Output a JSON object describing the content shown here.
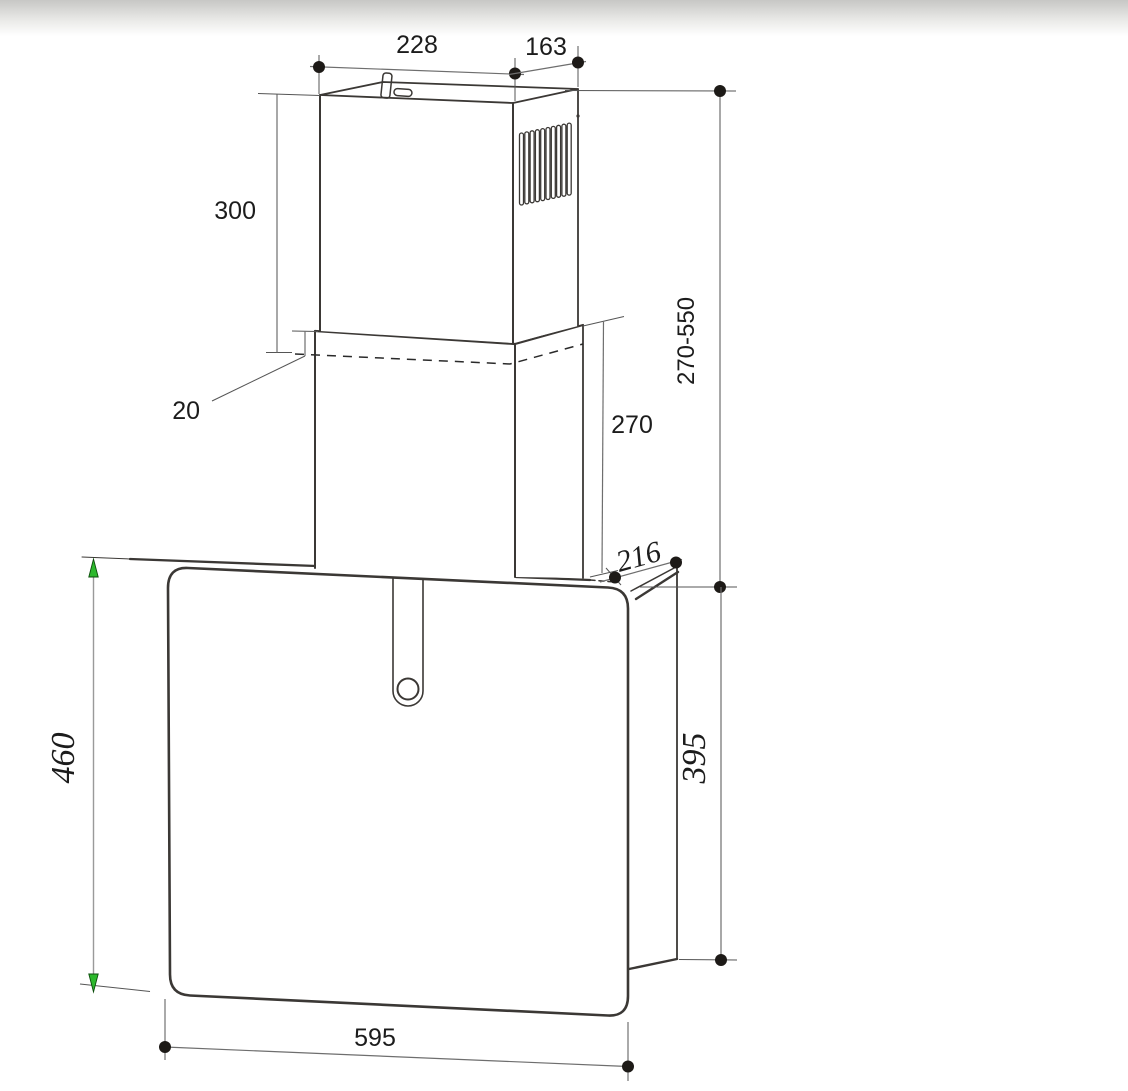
{
  "drawing": {
    "description": "Cooker hood installation dimensional drawing",
    "dimensions": {
      "top_width": "228",
      "top_depth": "163",
      "upper_chimney_height": "300",
      "chimney_overlap": "20",
      "chimney_height_range": "270-550",
      "lower_chimney_height": "270",
      "hood_top_depth": "216",
      "front_panel_height": "460",
      "rear_height": "395",
      "hood_width": "595"
    },
    "colors": {
      "object_line": "#3b3835",
      "dimension_line": "#6e6e6e",
      "arrow_green": "#2db82d",
      "background": "#ffffff",
      "top_band": "#c7c7c5"
    }
  }
}
